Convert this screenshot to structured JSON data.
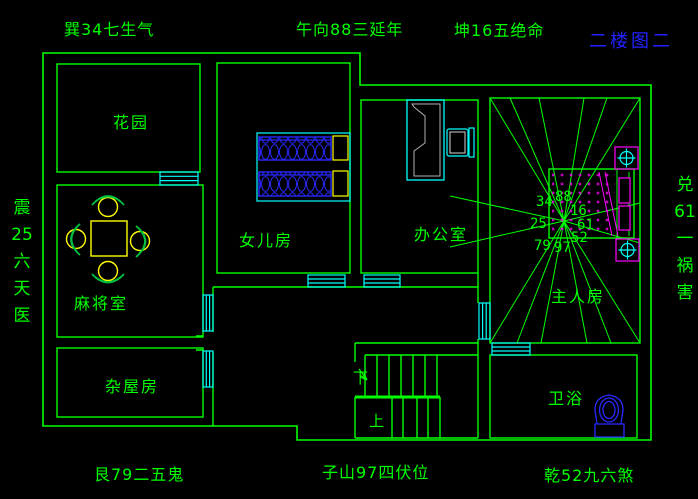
{
  "title": {
    "text": "二楼图二"
  },
  "compass": {
    "top_left": "巽34七生气",
    "top_center": "午向88三延年",
    "top_right": "坤16五绝命",
    "bottom_left": "艮79二五鬼",
    "bottom_center": "子山97四伏位",
    "bottom_right": "乾52九六煞",
    "left_chars": [
      "震",
      "25",
      "六",
      "天",
      "医"
    ],
    "right_chars": [
      "兑",
      "61",
      "一",
      "祸",
      "害"
    ]
  },
  "rooms": {
    "garden": {
      "label": "花园"
    },
    "mahjong": {
      "label": "麻将室"
    },
    "storage": {
      "label": "杂屋房"
    },
    "daughter": {
      "label": "女儿房"
    },
    "office": {
      "label": "办公室"
    },
    "master": {
      "label": "主人房"
    },
    "bathroom": {
      "label": "卫浴"
    }
  },
  "stairs": {
    "down_label": "下",
    "up_label": "上"
  },
  "luoshu": {
    "nw": "34",
    "n": "88",
    "ne": "16",
    "w": "25",
    "e": "61",
    "sw": "79",
    "s": "97",
    "se": "52"
  },
  "colors": {
    "background": "#000000",
    "wall_line": "#00ff00",
    "window": "#00ffff",
    "fixture_blue": "#2828ff",
    "accent_yellow": "#ffff00",
    "accent_magenta": "#ff00ff",
    "title_blue": "#2222ff",
    "desk_gray": "#b0b0b0"
  }
}
